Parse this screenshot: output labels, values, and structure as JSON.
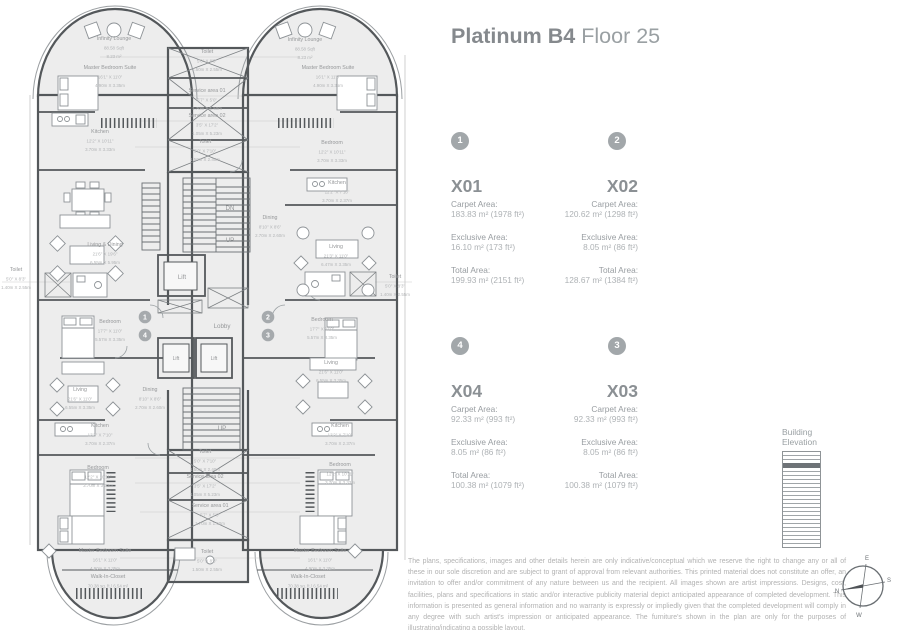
{
  "title": {
    "name": "Platinum B4",
    "floor": "Floor 25"
  },
  "area_labels": {
    "carpet": "Carpet Area:",
    "exclusive": "Exclusive Area:",
    "total": "Total Area:"
  },
  "units": [
    {
      "marker": "1",
      "code": "X01",
      "carpet": "183.83 m² (1978 ft²)",
      "exclusive": "16.10 m² (173 ft²)",
      "total": "199.93 m² (2151 ft²)"
    },
    {
      "marker": "2",
      "code": "X02",
      "carpet": "120.62 m² (1298 ft²)",
      "exclusive": "8.05 m² (86 ft²)",
      "total": "128.67 m² (1384 ft²)"
    },
    {
      "marker": "4",
      "code": "X04",
      "carpet": "92.33 m² (993 ft²)",
      "exclusive": "8.05 m² (86 ft²)",
      "total": "100.38 m² (1079 ft²)"
    },
    {
      "marker": "3",
      "code": "X03",
      "carpet": "92.33 m² (993 ft²)",
      "exclusive": "8.05 m² (86 ft²)",
      "total": "100.38 m² (1079 ft²)"
    }
  ],
  "building_elevation": {
    "label_line1": "Building",
    "label_line2": "Elevation",
    "floors": 24,
    "highlighted_floor_from_top": 4
  },
  "compass": {
    "n": "N",
    "e": "E",
    "s": "S",
    "w": "W"
  },
  "disclaimer": "The plans, specifications, images and other details herein are only indicative/conceptual which we reserve the right to change any or all of these in our sole discretion and are subject to grant of approval from relevant authorities. This printed material does not constitute an offer, an invitation to offer and/or commitment of any nature between us and the recipient. All images shown are artist impressions. Designs, cost, facilities, plans and specifications in static and/or interactive publicity material depict anticipated appearance of completed development. This information is presented as general information and no warranty is expressly or impliedly given that the completed development will comply in any degree with such artist's impression or anticipated appearance. The furniture's shown in the plan are only for the purposes of illustrating/indicating a possible layout.",
  "floor_plan": {
    "unit_markers": [
      {
        "n": "1",
        "x": 145,
        "y": 317
      },
      {
        "n": "4",
        "x": 145,
        "y": 335
      },
      {
        "n": "2",
        "x": 268,
        "y": 317
      },
      {
        "n": "3",
        "x": 268,
        "y": 335
      }
    ],
    "labels": [
      {
        "x": 114,
        "y": 40,
        "lines": [
          "Infinity Lounge",
          "88.58 Sqft",
          "8.23 m²"
        ]
      },
      {
        "x": 110,
        "y": 69,
        "lines": [
          "Master Bedroom Suite",
          "16'1\" X 11'0\"",
          "4.90m X 3.35m"
        ]
      },
      {
        "x": 100,
        "y": 133,
        "lines": [
          "Kitchen",
          "12'2\" X 10'11\"",
          "3.70m X 3.33m"
        ]
      },
      {
        "x": 105,
        "y": 246,
        "lines": [
          "Living & Dining",
          "21'6\" X 19'6\"",
          "6.55m X 5.95m"
        ]
      },
      {
        "x": 16,
        "y": 271,
        "lines": [
          "Toilet",
          "5'0\" X 8'3\"",
          "1.40m X 2.55m"
        ]
      },
      {
        "x": 110,
        "y": 323,
        "lines": [
          "Bedroom",
          "17'7\" X 11'0\"",
          "5.57m X 3.35m"
        ]
      },
      {
        "x": 80,
        "y": 391,
        "lines": [
          "Living",
          "21'6\" X 11'0\"",
          "6.55m X 3.35m"
        ]
      },
      {
        "x": 150,
        "y": 391,
        "lines": [
          "Dining",
          "8'10\" X 8'6\"",
          "2.70m X 2.60m"
        ]
      },
      {
        "x": 100,
        "y": 427,
        "lines": [
          "Kitchen",
          "12'2\" X 7'10\"",
          "3.70m X 2.37m"
        ]
      },
      {
        "x": 98,
        "y": 469,
        "lines": [
          "Bedroom",
          "12'2\" X 10'11\"",
          "3.70m X 3.33m"
        ]
      },
      {
        "x": 105,
        "y": 552,
        "lines": [
          "Master Bedroom Suite",
          "16'1\" X 11'0\"",
          "4.90m X 3.35m"
        ]
      },
      {
        "x": 108,
        "y": 578,
        "lines": [
          "Walk-In-Closet",
          "70.38 sq. ft./ 6.54 m²"
        ]
      },
      {
        "x": 207,
        "y": 53,
        "lines": [
          "Toilet",
          "5'0\" X 8'3\"",
          "1.50m X 2.55m"
        ]
      },
      {
        "x": 207,
        "y": 92,
        "lines": [
          "Service area 01",
          "5'7\" X 5'0\"",
          "1.70m X 1.50m"
        ]
      },
      {
        "x": 207,
        "y": 117,
        "lines": [
          "Service area 02",
          "3'5\" X 17'2\"",
          "1.05m X 5.23m"
        ]
      },
      {
        "x": 205,
        "y": 143,
        "lines": [
          "Toilet",
          "5'0\" X 7'10\"",
          "1.50m X 2.40m"
        ]
      },
      {
        "x": 182,
        "y": 279,
        "lines": [
          "Lift"
        ],
        "size": 6.2
      },
      {
        "x": 222,
        "y": 328,
        "lines": [
          "Lobby"
        ],
        "size": 6.2
      },
      {
        "x": 230,
        "y": 210,
        "lines": [
          "DN"
        ],
        "size": 6.2
      },
      {
        "x": 230,
        "y": 242,
        "lines": [
          "UP"
        ],
        "size": 6.2
      },
      {
        "x": 176,
        "y": 360,
        "lines": [
          "Lift"
        ],
        "size": 5
      },
      {
        "x": 214,
        "y": 360,
        "lines": [
          "Lift"
        ],
        "size": 5
      },
      {
        "x": 222,
        "y": 430,
        "lines": [
          "UP"
        ],
        "size": 6.2
      },
      {
        "x": 270,
        "y": 219,
        "lines": [
          "Dining",
          "8'10\" X 8'6\"",
          "2.70m X 2.60m"
        ]
      },
      {
        "x": 305,
        "y": 41,
        "lines": [
          "Infinity Lounge",
          "88.58 Sqft",
          "8.23 m²"
        ]
      },
      {
        "x": 328,
        "y": 69,
        "lines": [
          "Master Bedroom Suite",
          "16'1\" X 11'0\"",
          "4.90m X 3.35m"
        ]
      },
      {
        "x": 332,
        "y": 144,
        "lines": [
          "Bedroom",
          "12'2\" X 10'11\"",
          "3.70m X 3.33m"
        ]
      },
      {
        "x": 337,
        "y": 184,
        "lines": [
          "Kitchen",
          "12'2\" X 7'10\"",
          "3.70m X 2.37m"
        ]
      },
      {
        "x": 336,
        "y": 248,
        "lines": [
          "Living",
          "21'3\" X 11'0\"",
          "6.47m X 3.35m"
        ]
      },
      {
        "x": 395,
        "y": 278,
        "lines": [
          "Toilet",
          "5'0\" X 8'3\"",
          "1.40m X 2.55m"
        ]
      },
      {
        "x": 322,
        "y": 321,
        "lines": [
          "Bedroom",
          "17'7\" X 11'0\"",
          "5.57m X 3.35m"
        ]
      },
      {
        "x": 331,
        "y": 364,
        "lines": [
          "Living",
          "21'6\" X 11'0\"",
          "6.55m X 3.35m"
        ]
      },
      {
        "x": 340,
        "y": 427,
        "lines": [
          "Kitchen",
          "12'2\" X 7'10\"",
          "3.70m X 2.37m"
        ]
      },
      {
        "x": 340,
        "y": 466,
        "lines": [
          "Bedroom",
          "12'2\" X 10'11\"",
          "3.70m X 3.33m"
        ]
      },
      {
        "x": 320,
        "y": 552,
        "lines": [
          "Master Bedroom Suite",
          "16'1\" X 11'0\"",
          "4.90m X 3.35m"
        ]
      },
      {
        "x": 308,
        "y": 578,
        "lines": [
          "Walk-In-Closet",
          "70.38 sq. ft./ 6.54 m²"
        ]
      },
      {
        "x": 205,
        "y": 453,
        "lines": [
          "Toilet",
          "5'0\" X 7'10\"",
          "1.50m X 2.40m"
        ]
      },
      {
        "x": 205,
        "y": 478,
        "lines": [
          "Service area 02",
          "3'5\" X 17'2\"",
          "1.05m X 5.23m"
        ]
      },
      {
        "x": 210,
        "y": 507,
        "lines": [
          "Service area 01",
          "5'7\" X 5'0\"",
          "1.70m X 1.50m"
        ]
      },
      {
        "x": 207,
        "y": 553,
        "lines": [
          "Toilet",
          "5'0\" X 8'3\"",
          "1.50m X 2.55m"
        ]
      }
    ]
  }
}
